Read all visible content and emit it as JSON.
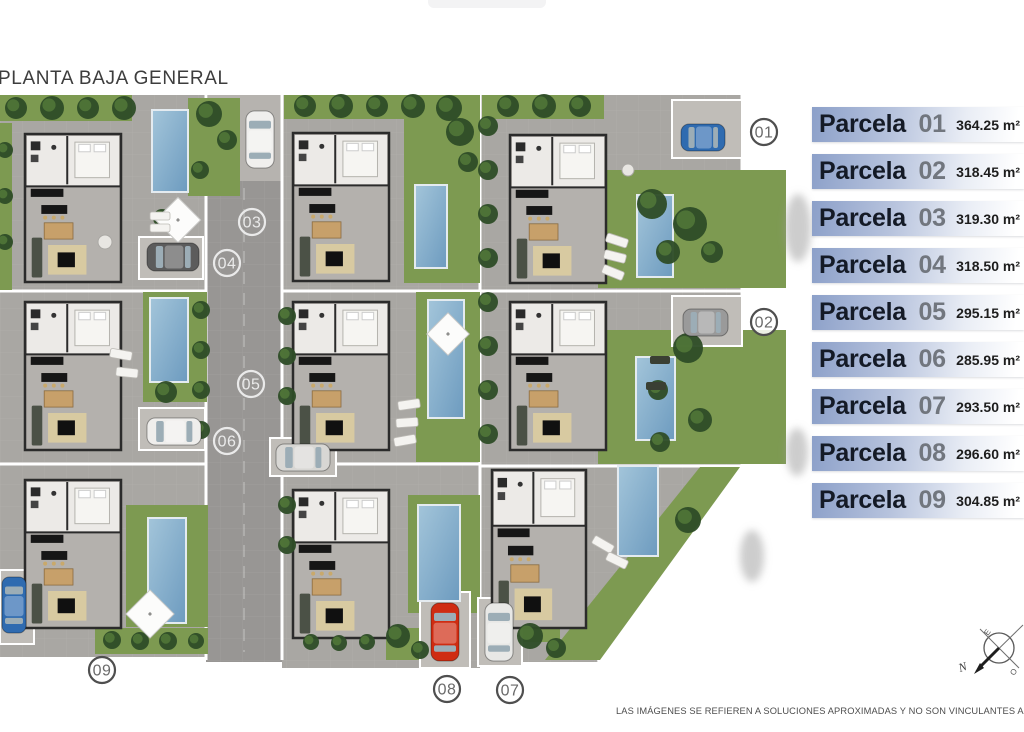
{
  "title": "PLANTA BAJA GENERAL",
  "disclaimer": "LAS IMÁGENES SE REFIEREN A SOLUCIONES APROXIMADAS Y NO SON VINCULANTES AL PROYECTO FINAL",
  "legend": {
    "rows": [
      {
        "label": "Parcela",
        "number": "01",
        "area": "364.25",
        "unit": "m²"
      },
      {
        "label": "Parcela",
        "number": "02",
        "area": "318.45",
        "unit": "m²"
      },
      {
        "label": "Parcela",
        "number": "03",
        "area": "319.30",
        "unit": "m²"
      },
      {
        "label": "Parcela",
        "number": "04",
        "area": "318.50",
        "unit": "m²"
      },
      {
        "label": "Parcela",
        "number": "05",
        "area": "295.15",
        "unit": "m²"
      },
      {
        "label": "Parcela",
        "number": "06",
        "area": "285.95",
        "unit": "m²"
      },
      {
        "label": "Parcela",
        "number": "07",
        "area": "293.50",
        "unit": "m²"
      },
      {
        "label": "Parcela",
        "number": "08",
        "area": "296.60",
        "unit": "m²"
      },
      {
        "label": "Parcela",
        "number": "09",
        "area": "304.85",
        "unit": "m²"
      }
    ]
  },
  "compass": {
    "north": "N",
    "east": "E",
    "west": "O"
  },
  "site_plan": {
    "colors": {
      "pavement": "#a9a7a3",
      "road": "#989694",
      "road_pad": "#b6b3af",
      "pad": "#c0bdb8",
      "grass": "#7d9a51",
      "tree_dark": "#2f4d28",
      "tree_light": "#547a39",
      "pool_from": "#a3c5da",
      "pool_to": "#6d9bbf",
      "pool_stroke": "#e4ebf0",
      "house_floor": "#b4b1ad",
      "wall": "#2b2b2b",
      "room": "#eceae7",
      "marker_dark_ring": "#4f4f4f",
      "marker_dark_text": "#6a6a6a",
      "marker_light": "#eaeaea"
    },
    "markers": [
      {
        "label": "01",
        "x": 764,
        "y": 132,
        "style": "dark"
      },
      {
        "label": "02",
        "x": 764,
        "y": 322,
        "style": "dark"
      },
      {
        "label": "03",
        "x": 252,
        "y": 222,
        "style": "light"
      },
      {
        "label": "04",
        "x": 227,
        "y": 263,
        "style": "light"
      },
      {
        "label": "05",
        "x": 251,
        "y": 384,
        "style": "light"
      },
      {
        "label": "06",
        "x": 227,
        "y": 441,
        "style": "light"
      },
      {
        "label": "07",
        "x": 510,
        "y": 690,
        "style": "dark"
      },
      {
        "label": "08",
        "x": 447,
        "y": 689,
        "style": "dark"
      },
      {
        "label": "09",
        "x": 102,
        "y": 670,
        "style": "dark"
      }
    ],
    "pavement_rects": [
      [
        0,
        95,
        206,
        562
      ],
      [
        282,
        95,
        198,
        573
      ],
      [
        480,
        95,
        262,
        370
      ]
    ],
    "pavement_polys": [
      "480,465 742,465 598,662 480,662"
    ],
    "road": [
      206,
      95,
      76,
      567
    ],
    "road_pad": [
      208,
      95,
      74,
      86
    ],
    "lines": [
      [
        206,
        95,
        206,
        660
      ],
      [
        282,
        95,
        282,
        660
      ],
      [
        480,
        95,
        480,
        662
      ],
      [
        742,
        95,
        742,
        465
      ],
      [
        0,
        291,
        206,
        291
      ],
      [
        282,
        291,
        480,
        291
      ],
      [
        480,
        291,
        742,
        291
      ],
      [
        0,
        464,
        206,
        464
      ],
      [
        282,
        464,
        480,
        464
      ],
      [
        480,
        466,
        742,
        466
      ],
      [
        742,
        465,
        598,
        662
      ]
    ],
    "grass_rects": [
      [
        0,
        95,
        132,
        26
      ],
      [
        188,
        98,
        52,
        98
      ],
      [
        0,
        123,
        12,
        167
      ],
      [
        143,
        292,
        64,
        110
      ],
      [
        126,
        505,
        82,
        122
      ],
      [
        95,
        628,
        113,
        26
      ],
      [
        284,
        95,
        196,
        24
      ],
      [
        404,
        115,
        76,
        168
      ],
      [
        416,
        292,
        64,
        170
      ],
      [
        408,
        495,
        72,
        118
      ],
      [
        386,
        628,
        52,
        32
      ],
      [
        482,
        95,
        122,
        24
      ],
      [
        598,
        170,
        188,
        118
      ],
      [
        598,
        330,
        188,
        134
      ],
      [
        516,
        598,
        44,
        44
      ]
    ],
    "grass_polys": [
      "700,467 740,467 600,660 545,660"
    ],
    "pools": [
      [
        152,
        110,
        36,
        82
      ],
      [
        150,
        298,
        38,
        84
      ],
      [
        148,
        518,
        38,
        105
      ],
      [
        415,
        185,
        32,
        83
      ],
      [
        428,
        300,
        36,
        118
      ],
      [
        418,
        505,
        42,
        96
      ],
      [
        637,
        195,
        36,
        82
      ],
      [
        636,
        357,
        39,
        83
      ],
      [
        618,
        466,
        40,
        90
      ]
    ],
    "pads": [
      [
        139,
        237,
        64,
        42
      ],
      [
        139,
        408,
        66,
        42
      ],
      [
        270,
        438,
        66,
        38
      ],
      [
        672,
        100,
        70,
        58
      ],
      [
        672,
        296,
        70,
        50
      ],
      [
        420,
        592,
        50,
        76
      ],
      [
        478,
        598,
        44,
        68
      ],
      [
        0,
        570,
        34,
        74
      ]
    ],
    "houses": [
      [
        25,
        134,
        96,
        148
      ],
      [
        25,
        302,
        96,
        148
      ],
      [
        25,
        480,
        96,
        148
      ],
      [
        293,
        133,
        96,
        148
      ],
      [
        293,
        302,
        96,
        148
      ],
      [
        293,
        490,
        96,
        148
      ],
      [
        510,
        135,
        96,
        148
      ],
      [
        510,
        302,
        96,
        148
      ],
      [
        492,
        470,
        94,
        158
      ]
    ],
    "trees": [
      [
        16,
        108,
        11
      ],
      [
        52,
        108,
        12
      ],
      [
        88,
        108,
        11
      ],
      [
        124,
        108,
        12
      ],
      [
        209,
        114,
        13
      ],
      [
        227,
        140,
        10
      ],
      [
        200,
        170,
        9
      ],
      [
        5,
        150,
        8
      ],
      [
        5,
        196,
        8
      ],
      [
        5,
        242,
        8
      ],
      [
        201,
        310,
        9
      ],
      [
        201,
        350,
        9
      ],
      [
        201,
        390,
        9
      ],
      [
        201,
        430,
        9
      ],
      [
        287,
        316,
        9
      ],
      [
        287,
        356,
        9
      ],
      [
        287,
        396,
        9
      ],
      [
        287,
        505,
        9
      ],
      [
        287,
        545,
        9
      ],
      [
        305,
        106,
        11
      ],
      [
        341,
        106,
        12
      ],
      [
        377,
        106,
        11
      ],
      [
        413,
        106,
        12
      ],
      [
        449,
        108,
        13
      ],
      [
        460,
        132,
        14
      ],
      [
        468,
        162,
        10
      ],
      [
        488,
        126,
        10
      ],
      [
        488,
        170,
        10
      ],
      [
        488,
        214,
        10
      ],
      [
        488,
        258,
        10
      ],
      [
        488,
        302,
        10
      ],
      [
        488,
        346,
        10
      ],
      [
        488,
        390,
        10
      ],
      [
        488,
        434,
        10
      ],
      [
        508,
        106,
        11
      ],
      [
        544,
        106,
        12
      ],
      [
        580,
        106,
        11
      ],
      [
        652,
        204,
        15
      ],
      [
        690,
        224,
        17
      ],
      [
        668,
        252,
        12
      ],
      [
        712,
        252,
        11
      ],
      [
        688,
        348,
        15
      ],
      [
        658,
        390,
        10
      ],
      [
        700,
        420,
        12
      ],
      [
        660,
        442,
        10
      ],
      [
        530,
        636,
        13
      ],
      [
        556,
        648,
        10
      ],
      [
        688,
        520,
        13
      ],
      [
        398,
        636,
        12
      ],
      [
        420,
        650,
        9
      ],
      [
        112,
        640,
        9
      ],
      [
        140,
        641,
        9
      ],
      [
        168,
        641,
        9
      ],
      [
        196,
        641,
        8
      ],
      [
        311,
        642,
        8
      ],
      [
        339,
        643,
        8
      ],
      [
        367,
        642,
        8
      ],
      [
        166,
        392,
        11
      ],
      [
        181,
        430,
        9
      ],
      [
        162,
        218,
        9
      ]
    ],
    "cars": [
      [
        246,
        111,
        28,
        57,
        "#f0efed"
      ],
      [
        147,
        243,
        52,
        28,
        "#5c5c5c"
      ],
      [
        681,
        124,
        44,
        27,
        "#2f6bb0"
      ],
      [
        683,
        309,
        45,
        27,
        "#9a9a9a"
      ],
      [
        147,
        418,
        54,
        27,
        "#efeeec"
      ],
      [
        276,
        444,
        54,
        27,
        "#d8d7d4"
      ],
      [
        2,
        577,
        24,
        56,
        "#2f6bb0"
      ],
      [
        431,
        603,
        28,
        58,
        "#cf2c12"
      ],
      [
        485,
        603,
        28,
        58,
        "#e8e8e6"
      ]
    ],
    "umbrellas": [
      [
        178,
        220,
        16
      ],
      [
        448,
        334,
        15
      ],
      [
        150,
        614,
        17
      ]
    ],
    "loungers": [
      [
        150,
        212,
        20,
        8,
        0
      ],
      [
        150,
        224,
        20,
        8,
        0
      ],
      [
        110,
        350,
        22,
        9,
        10
      ],
      [
        116,
        368,
        22,
        9,
        6
      ],
      [
        398,
        400,
        22,
        9,
        -8
      ],
      [
        396,
        418,
        22,
        9,
        -4
      ],
      [
        394,
        436,
        22,
        9,
        -10
      ],
      [
        606,
        236,
        22,
        9,
        18
      ],
      [
        604,
        252,
        22,
        9,
        14
      ],
      [
        602,
        268,
        22,
        9,
        22
      ],
      [
        592,
        540,
        22,
        9,
        30
      ],
      [
        606,
        556,
        22,
        9,
        26
      ]
    ],
    "benches": [
      [
        650,
        356,
        20,
        8
      ],
      [
        646,
        382,
        20,
        8
      ]
    ],
    "tables": [
      [
        105,
        242,
        7
      ],
      [
        628,
        170,
        6
      ]
    ],
    "shadows": [
      [
        798,
        228,
        13,
        34
      ],
      [
        797,
        452,
        11,
        24
      ],
      [
        752,
        556,
        12,
        26
      ]
    ]
  }
}
